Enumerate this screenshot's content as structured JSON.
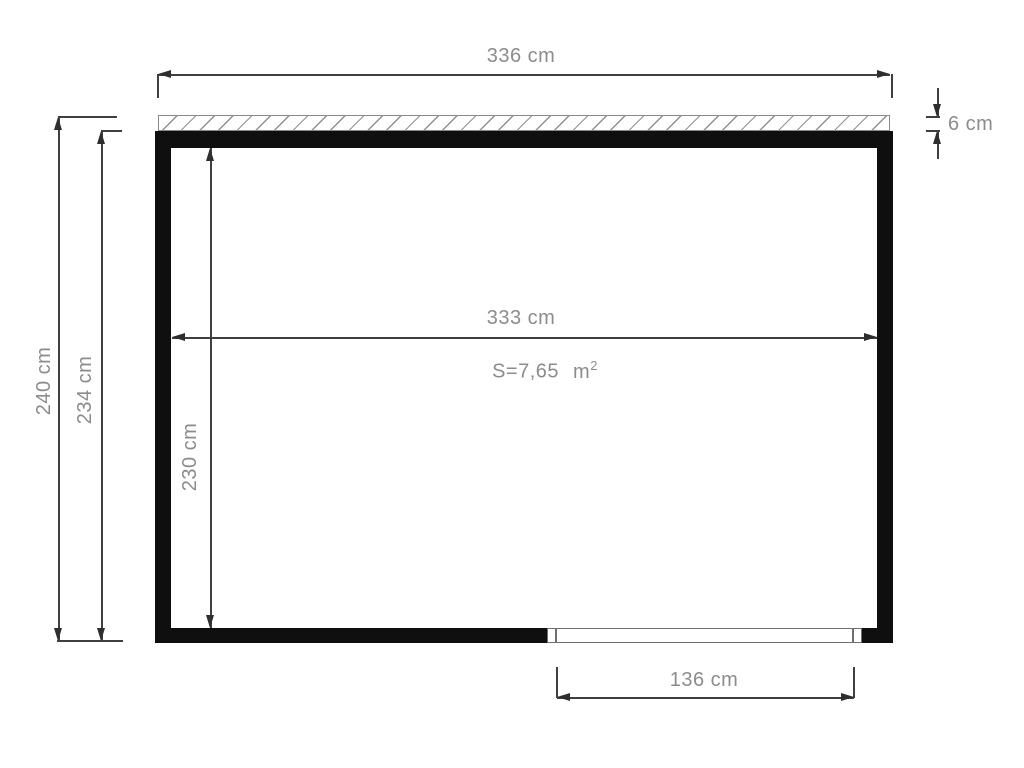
{
  "drawing": {
    "type": "floor plan",
    "dimensions": {
      "outer_width": "336 cm",
      "roof_thickness": "6 cm",
      "outer_height": "240 cm",
      "wall_height": "234 cm",
      "inner_width": "333 cm",
      "inner_height": "230 cm",
      "door_width": "136 cm"
    },
    "area": {
      "prefix": "S=7,65",
      "unit": "m",
      "exponent": "2"
    },
    "colors": {
      "background": "#ffffff",
      "wall": "#0f0f0f",
      "dimension_line": "#3f3f3f",
      "text": "#8c8c8c",
      "hatch": "#909090"
    }
  }
}
